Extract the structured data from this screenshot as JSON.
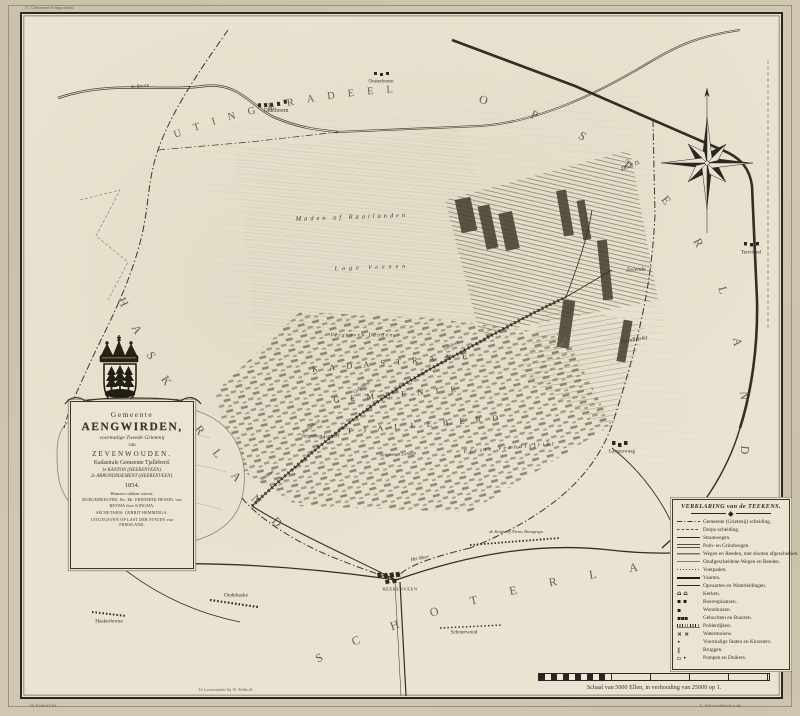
{
  "palette": {
    "paper": "#cfc7b1",
    "field": "#e9e3d1",
    "ink": "#2b2620",
    "line": "#3a342c",
    "hatch": "#a79d85",
    "water": "#e7e1cf"
  },
  "sheet": {
    "plate_note": "17. Gemeente Aengwirden.",
    "publisher": "Te Leeuwarden bij W. Eekhoff.",
    "credit_left": "W. Eekhoff del.",
    "credit_right": "L. Schweickhardt sculp."
  },
  "cartouche": {
    "pre_title": "Gemeente",
    "title": "AENGWIRDEN,",
    "sub1": "voormalige Tweede Grietenij",
    "sub2": "van",
    "sub3": "ZEVENWOUDEN.",
    "sub4": "Kadastrale Gemeente Tjalleberd.",
    "sub5": "1e KANTON (HEERENVEEN).",
    "sub6": "2e ARRONDISSEMENT (HEERENVEEN).",
    "year": "1854.",
    "note": "Wanneer aldaar waren:",
    "official1": "BURGEMEESTER, Jhr. Mr. FREDERIK HESSEL van BEYMA thoe KINGMA.",
    "official2": "SECRETARIS: GERRIT HEMMINGA.",
    "issue_note": "UITGEGEVEN OP LAST DER STATEN van FRIESLAND."
  },
  "regions": {
    "north": "UTINGERADEEL",
    "east": "OPSTERLAND",
    "south": "SCHOTERLAND",
    "west": "HASKERLAND"
  },
  "labels": {
    "oldeboorn": "Oldeboorn",
    "oosterboorn": "Oosterboorn",
    "boorn": "de Boorn",
    "maden": "Maden of Raailanden",
    "lage_veenen": "Lage Veenen",
    "vergraven": "Vergraven Landen",
    "kadastrale": "KADASTRALE",
    "gemeente": "GEMEENTE",
    "tjalleberd": "TJALLEBERD",
    "eerste_veendistrikt": "Eerste Veendistrikt",
    "zesde": "Zesde D.",
    "zevende": "Zevende",
    "veendistrikt": "Veendistrikt",
    "terwispel": "Terwispel",
    "langezwaag": "Langezwaag",
    "heerenveen": "HEERENVEEN",
    "het_meer": "Het Meer",
    "knijpe": "de Knijpe of Nieuw Brongerga",
    "schoterwoud": "Schoterwoud",
    "oudehaske": "Oudehaske",
    "haskerhorne": "Haskerhorne",
    "terband": "Terband",
    "luinjeberd": "Luinjeberd",
    "tjalleberd_dorp": "Tjalleberd",
    "gersloot": "Gersloot"
  },
  "legend": {
    "title": "VERKLARING van de TEEKENS.",
    "items": [
      {
        "label": "Gemeente (Grietenij) scheiding."
      },
      {
        "label": "Dorps-scheiding."
      },
      {
        "label": "Straatwegen."
      },
      {
        "label": "Puin- en Grindwegen."
      },
      {
        "label": "Wegen en Reeden, met slooten afgescheiden."
      },
      {
        "label": "Onafgescheidene Wegen en Reeden."
      },
      {
        "label": "Voetpaden."
      },
      {
        "label": "Vaarten."
      },
      {
        "label": "Opvaarten en Waterleidingen."
      },
      {
        "label": "Kerken."
      },
      {
        "label": "Boerenplaatsen."
      },
      {
        "label": "Woonhuizen."
      },
      {
        "label": "Gehuchten en Buurten."
      },
      {
        "label": "Polderdijken."
      },
      {
        "label": "Watermolens."
      },
      {
        "label": "Voormalige Staten en Kloosters."
      },
      {
        "label": "Bruggen."
      },
      {
        "label": "Pompen en Duikers."
      }
    ]
  },
  "scale": {
    "caption": "Schaal van 5000 Ellen, in verhouding van 25000 op 1."
  }
}
